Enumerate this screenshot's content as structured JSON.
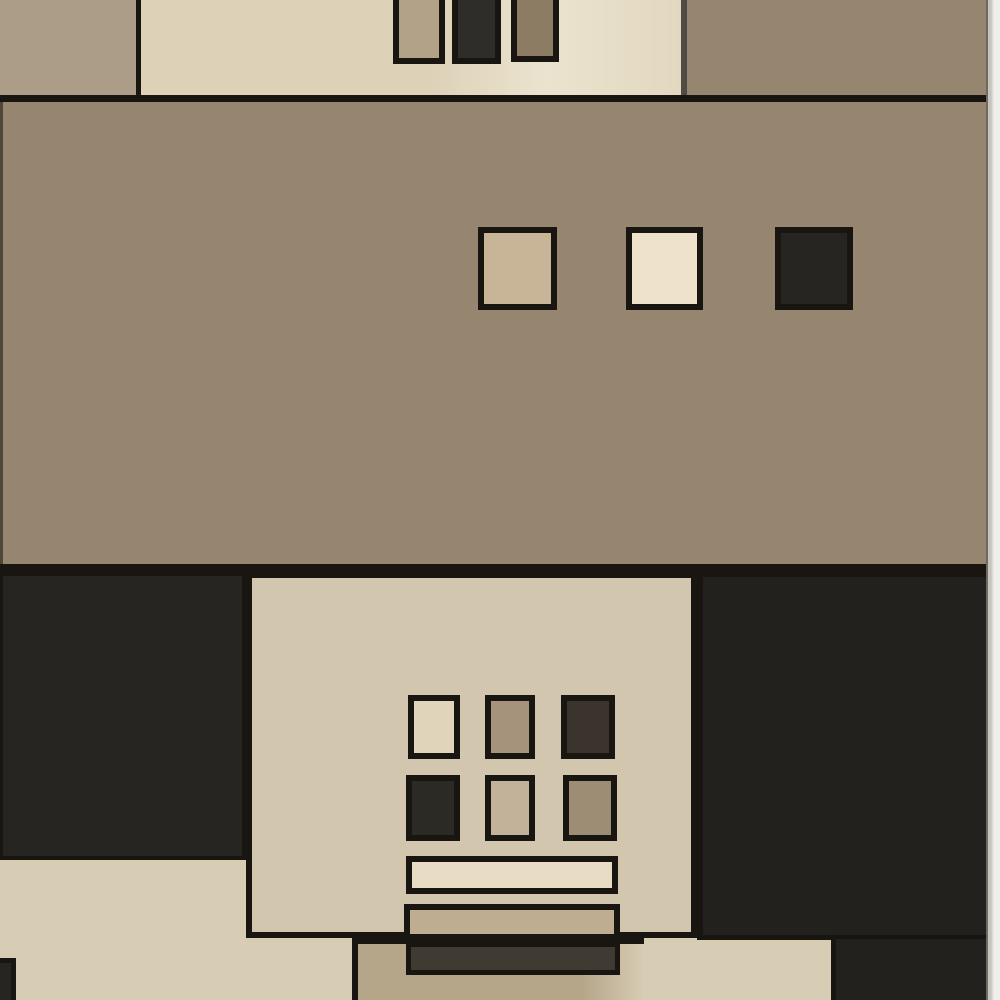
{
  "image_type": "photograph",
  "subject": "Modern geometric area rug photographed flat: color-blocked pattern of beige, cream, brown and charcoal rectangles with small black-outlined squares and bars",
  "palette": {
    "photo_bg": "#efeeea",
    "line": "#191511",
    "top_left_tan": "#ab9d87",
    "cream_panel": "#ddd2b8",
    "top_rect_tan": "#b2a288",
    "top_rect_dark": "#2f2d29",
    "top_rect_brown": "#8d7c64",
    "brown_band": "#97866f",
    "charcoal_block": "#272522",
    "right_dark": "#23211e",
    "beige_bottom": "#d7ccb4",
    "panel_beige": "#d2c6ae",
    "sq_mid_tan": "#c8b497",
    "sq_mid_cream": "#eee3ca",
    "sq_cream2": "#e0d4bb",
    "sq_taupe": "#a6937b",
    "sq_dark3": "#3a342c",
    "sq_dark4": "#2c2a25",
    "sq_tan5": "#c3b29a",
    "sq_taupe6": "#9e8d75",
    "bar_cream": "#e8ddc4",
    "bar_tan": "#bead90",
    "bar_dark": "#403b32",
    "bottom_tan_block": "#b5a589"
  },
  "regions": [
    "top-left-tan-block",
    "top-cream-panel",
    "top-small-rect-tan",
    "top-small-rect-dark",
    "top-small-rect-brown",
    "top-right-brown-block",
    "middle-brown-band",
    "middle-square-tan",
    "middle-square-cream",
    "middle-square-dark",
    "bottom-left-charcoal-block",
    "center-beige-panel",
    "panel-square-grid-2x3",
    "panel-cream-bar",
    "panel-tan-bar",
    "right-charcoal-block",
    "bottom-tan-block",
    "bottom-dark-bar",
    "bottom-right-charcoal-block",
    "photo-background-edge"
  ]
}
